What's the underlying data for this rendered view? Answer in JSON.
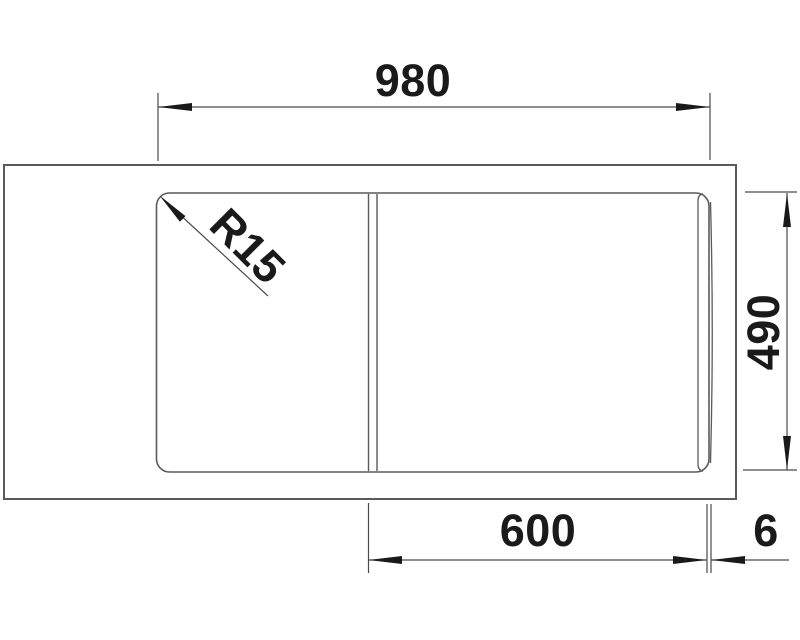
{
  "drawing": {
    "kind": "sink-top-view-dimension-drawing",
    "units_implied": "mm",
    "dimensions": {
      "overall_width": "980",
      "overall_depth": "490",
      "bowl_width": "600",
      "edge_gap": "6",
      "corner_radius": "R15"
    }
  },
  "colors": {
    "background": "#ffffff",
    "line": "#5a5a5a",
    "dim_line": "#4a4a4a",
    "text": "#1a1a1a"
  }
}
